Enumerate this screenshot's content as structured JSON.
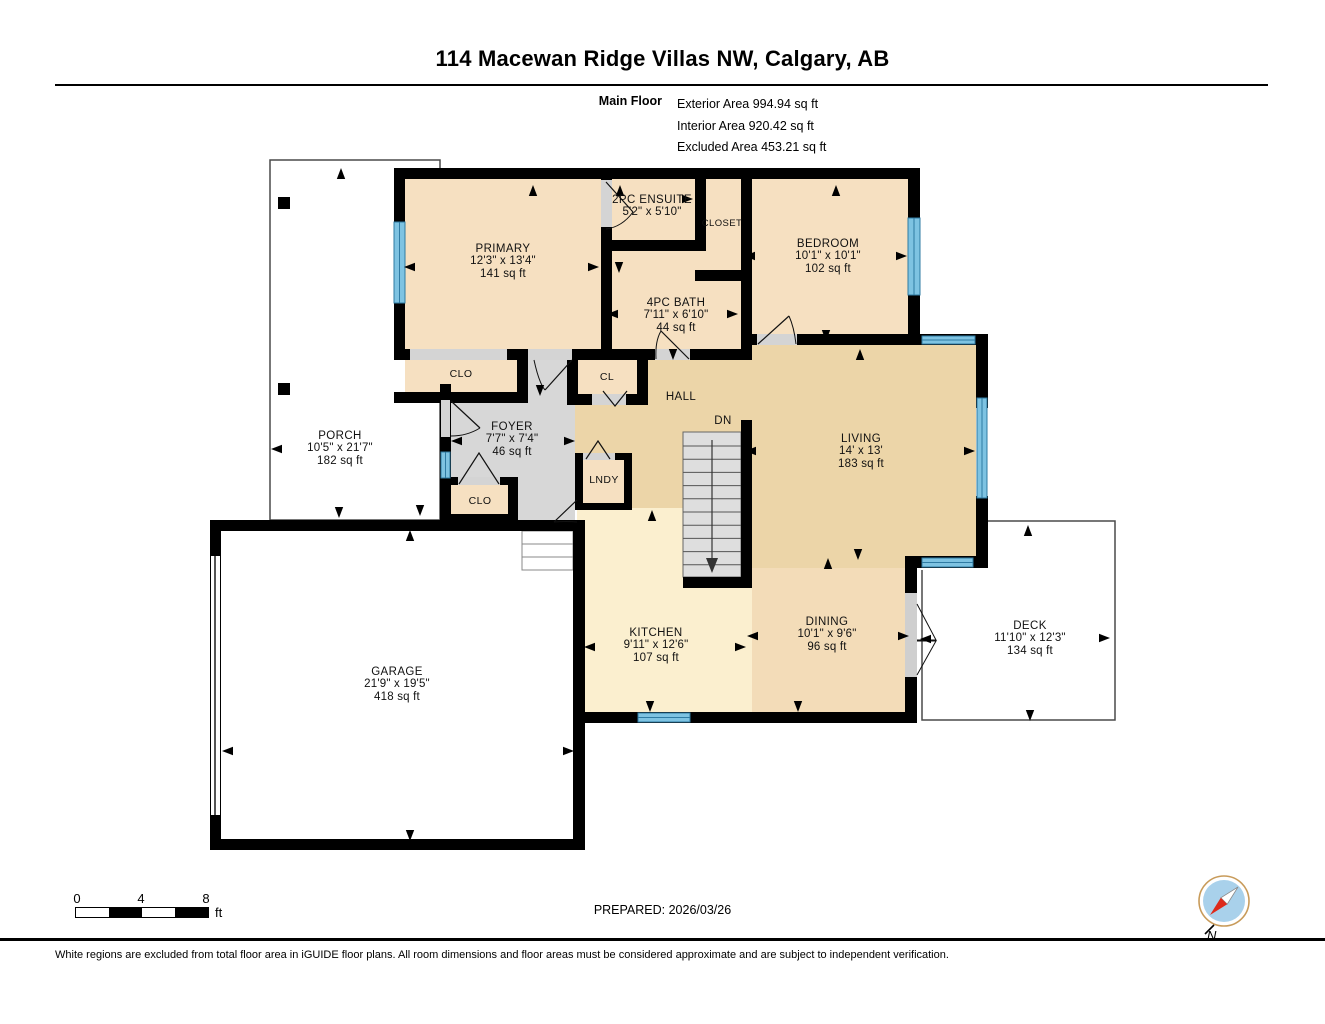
{
  "header": {
    "title": "114 Macewan Ridge Villas NW, Calgary, AB",
    "floor_label": "Main Floor",
    "area_lines": [
      "Exterior Area 994.94 sq ft",
      "Interior Area 920.42 sq ft",
      "Excluded Area 453.21 sq ft"
    ]
  },
  "plan": {
    "rooms": [
      {
        "name": "PRIMARY",
        "dims": "12'3\" x 13'4\"",
        "area": "141 sq ft"
      },
      {
        "name": "2PC ENSUITE",
        "dims": "5'2\" x 5'10\""
      },
      {
        "name": "CLOSET"
      },
      {
        "name": "4PC BATH",
        "dims": "7'11\" x 6'10\"",
        "area": "44 sq ft"
      },
      {
        "name": "BEDROOM",
        "dims": "10'1\" x 10'1\"",
        "area": "102 sq ft"
      },
      {
        "name": "CLO"
      },
      {
        "name": "CL"
      },
      {
        "name": "HALL"
      },
      {
        "name": "DN"
      },
      {
        "name": "FOYER",
        "dims": "7'7\" x 7'4\"",
        "area": "46 sq ft"
      },
      {
        "name": "CLO"
      },
      {
        "name": "LNDY"
      },
      {
        "name": "LIVING",
        "dims": "14' x 13'",
        "area": "183 sq ft"
      },
      {
        "name": "PORCH",
        "dims": "10'5\" x 21'7\"",
        "area": "182 sq ft"
      },
      {
        "name": "KITCHEN",
        "dims": "9'11\" x 12'6\"",
        "area": "107 sq ft"
      },
      {
        "name": "DINING",
        "dims": "10'1\" x 9'6\"",
        "area": "96 sq ft"
      },
      {
        "name": "DECK",
        "dims": "11'10\" x 12'3\"",
        "area": "134 sq ft"
      },
      {
        "name": "GARAGE",
        "dims": "21'9\" x 19'5\"",
        "area": "418 sq ft"
      }
    ]
  },
  "footer": {
    "prepared": "PREPARED: 2026/03/26",
    "scale_ticks": [
      "0",
      "4",
      "8"
    ],
    "scale_unit": "ft",
    "compass_label": "N",
    "disclaimer": "White regions are excluded from total floor area in iGUIDE floor plans. All room dimensions and floor areas must be considered approximate and are subject to independent verification."
  },
  "colors": {
    "wall": "#000000",
    "window_blue": "#7EC3E2",
    "window_edge": "#2F7BA3",
    "room_tan": "#F6E0C1",
    "hall_tan": "#ECD5A8",
    "dining_tan": "#F3DCB8",
    "kitchen_cream": "#FBEFCF",
    "foyer_gray": "#D7D7D7",
    "stair_gray": "#DEDEDE",
    "compass_red": "#DD2A1B"
  }
}
